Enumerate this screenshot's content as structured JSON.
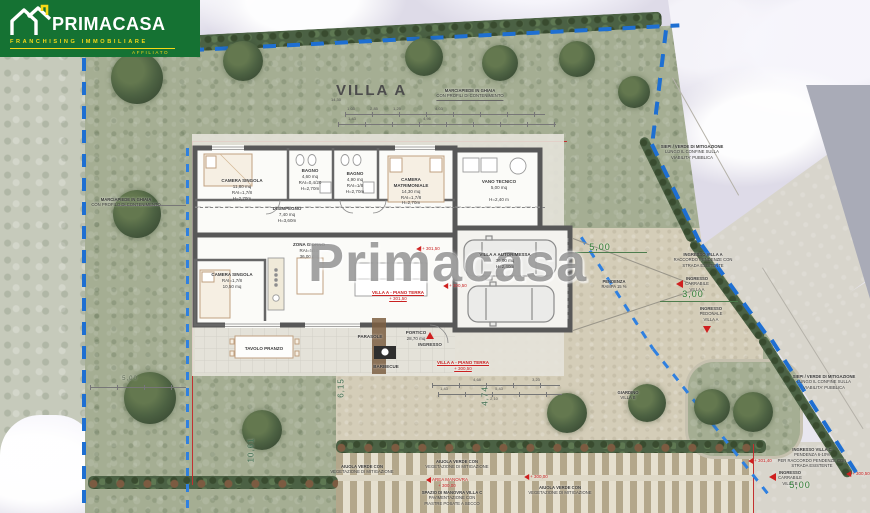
{
  "logo": {
    "brand": "PRIMACASA",
    "tagline": "FRANCHISING IMMOBILIARE",
    "affiliato": "AFFILIATO"
  },
  "watermark": "Primacasa",
  "plan": {
    "title": "VILLA A",
    "rooms": [
      [
        "CAMERA SINGOLA",
        "11,80 mq",
        "RAI=1,7/8",
        "H=2,70m"
      ],
      [
        "BAGNO",
        "4,60 mq",
        "RAI=0,4/20",
        "H=2,70m"
      ],
      [
        "BAGNO",
        "4,90 mq",
        "RAI=1/8",
        "H=2,70m"
      ],
      [
        "CAMERA",
        "MATRIMONIALE",
        "14,30 mq",
        "RAI=1,7/8",
        "H=2,70m"
      ],
      [
        "VANO TECNICO",
        "5,00 mq",
        "H=2,40 m"
      ],
      [
        "DISIMPEGNO",
        "7,40 mq",
        "H=3,60m"
      ],
      [
        "ZONA GIORNO",
        "RAI=5/10",
        "36,00 mq"
      ],
      [
        "CAMERA SINGOLA",
        "RAI=1,7/8",
        "10,50 mq"
      ],
      [
        "PORTICO",
        "28,70 mq"
      ],
      [
        "VILLA A AUTORIMESSA",
        "36,00 mq",
        "H=2,40m"
      ]
    ],
    "labels": {
      "tavolo": "TAVOLO PRANZO",
      "barbecue": "BARBECUE",
      "parasole": "PARASOLE",
      "ingresso": "INGRESSO"
    },
    "levels": [
      [
        "VILLA A - PIANO TERRA",
        "+ 301,50"
      ],
      [
        "VILLA A - PIANO TERRA",
        "+ 300,50"
      ]
    ],
    "markers": [
      "+ 300,50",
      "+ 301,50",
      "+ 300,00",
      "+ 301,40",
      "+ 300,50"
    ],
    "area_manovra": [
      "AREA MANOVRA",
      "+ 300,00"
    ]
  },
  "site": {
    "notes": [
      [
        "MARCIAPIEDE IN GHIAIA",
        "CON PROFILI DI CONTENIMENTO"
      ],
      [
        "MARCIAPIEDE IN GHIAIA",
        "CON PROFILO DI CONTENIMENTO"
      ],
      [
        "SIEPI / VERDE DI MITIGAZIONE",
        "LUNGO IL CONFINE SULLA",
        "VIABILITA' PUBBLICA"
      ],
      [
        "INGRESSO VILLA A",
        "RACCORDO PENDENZE CON",
        "STRADA ESISTENTE"
      ],
      [
        "INGRESSO",
        "CARRABILE",
        "VILLA A"
      ],
      [
        "INGRESSO",
        "PEDONALE",
        "VILLA A"
      ],
      [
        "PENDENZA",
        "RAMPA 15 %"
      ],
      [
        "AIUOLA VERDE CON",
        "VEGETAZIONE DI MITIGAZIONE"
      ],
      [
        "AIUOLA VERDE CON",
        "VEGETAZIONE DI MITIGAZIONE"
      ],
      [
        "SPAZIO DI MANOVRA VILLA C",
        "PAVIMENTAZIONE CON",
        "PIASTRE POSATE A SECCO"
      ],
      [
        "AIUOLA VERDE CON",
        "VEGETAZIONE DI MITIGAZIONE"
      ],
      [
        "SIEPI / VERDE DI MITIGAZIONE",
        "LUNGO IL CONFINE SULLA",
        "VIABILITA' PUBBLICA"
      ],
      [
        "INGRESSO VILLA C",
        "PENDENZA 6-10%",
        "PER RACCORDO PENDENZE CON",
        "STRADA ESISTENTE"
      ],
      [
        "INGRESSO",
        "CARRABILE",
        "VILLA B"
      ],
      [
        "GIARDINO",
        "VILLA B"
      ]
    ],
    "dims_green": [
      "5,00",
      "3,00",
      "5,00",
      "10,61",
      "4,74",
      "6,15",
      "5,00"
    ],
    "dims_small": [
      "14,30",
      "1,03",
      "2,85",
      "1,25",
      "4,03",
      "1,43",
      "4,96",
      "4,68",
      "3,23",
      "1,43",
      "5,43",
      "2,10"
    ]
  },
  "colors": {
    "logo_green": "#157233",
    "logo_yellow": "#f7d917",
    "boundary_blue": "#1e6fd2",
    "accent_red": "#cf1f1f",
    "dim_green": "#2e7d34"
  }
}
